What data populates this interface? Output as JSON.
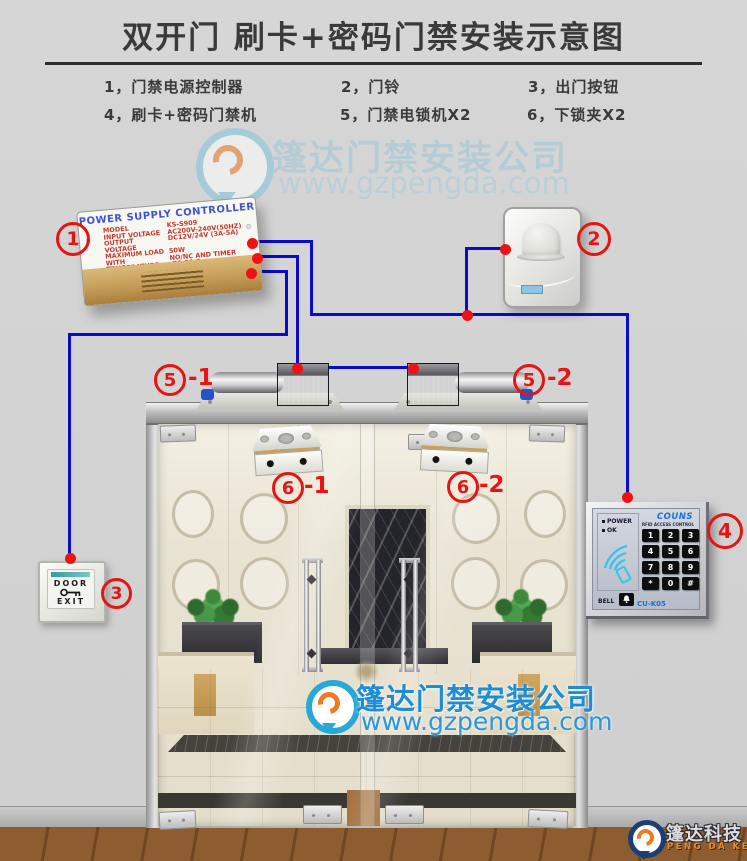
{
  "page": {
    "title": "双开门 刷卡+密码门禁安装示意图"
  },
  "legend": {
    "items": [
      "1，门禁电源控制器",
      "2，门铃",
      "3，出门按钮",
      "4，刷卡+密码门禁机",
      "5，门禁电锁机X2",
      "6，下锁夹X2"
    ]
  },
  "watermark": {
    "company": "篷达门禁安装公司",
    "url": "www.gzpengda.com"
  },
  "psu": {
    "number": "1",
    "title": "POWER SUPPLY CONTROLLER",
    "specs": [
      [
        "MODEL",
        "KS-S909"
      ],
      [
        "INPUT VOLTAGE",
        "AC200V-240V(50HZ)"
      ],
      [
        "OUTPUT VOLTAGE",
        "DC12V/24V (3A-5A)"
      ],
      [
        "MAXIMUM LOAD",
        "50W"
      ],
      [
        "WITH",
        "NO/NC AND TIMER"
      ],
      [
        "TEMPERATURE",
        "-20-50 C"
      ]
    ]
  },
  "doorbell": {
    "number": "2"
  },
  "exit_button": {
    "number": "3",
    "line1": "DOOR",
    "line2": "EXIT"
  },
  "keypad": {
    "number": "4",
    "brand": "COUNS",
    "subtitle": "RFID ACCESS CONTROL",
    "indicators": [
      "POWER",
      "OK"
    ],
    "bell": "BELL",
    "model": "CU-K05",
    "keys": [
      "1",
      "2",
      "3",
      "4",
      "5",
      "6",
      "7",
      "8",
      "9",
      "*",
      "0",
      "#"
    ]
  },
  "locks": {
    "number": "5",
    "left_suffix": "-1",
    "right_suffix": "-2"
  },
  "clamps": {
    "number": "6",
    "left_suffix": "-1",
    "right_suffix": "-2"
  },
  "footer": {
    "brand": "篷达科技",
    "brand_en": "PENG DA KE JI"
  },
  "colors": {
    "wire_blue": "#0a0acd",
    "dot_red": "#ee1212",
    "label_red": "#e51515",
    "watermark_blue": "#1d8ed6",
    "brand_blue": "#1b6fd8",
    "psu_gold": "#c29a55"
  }
}
